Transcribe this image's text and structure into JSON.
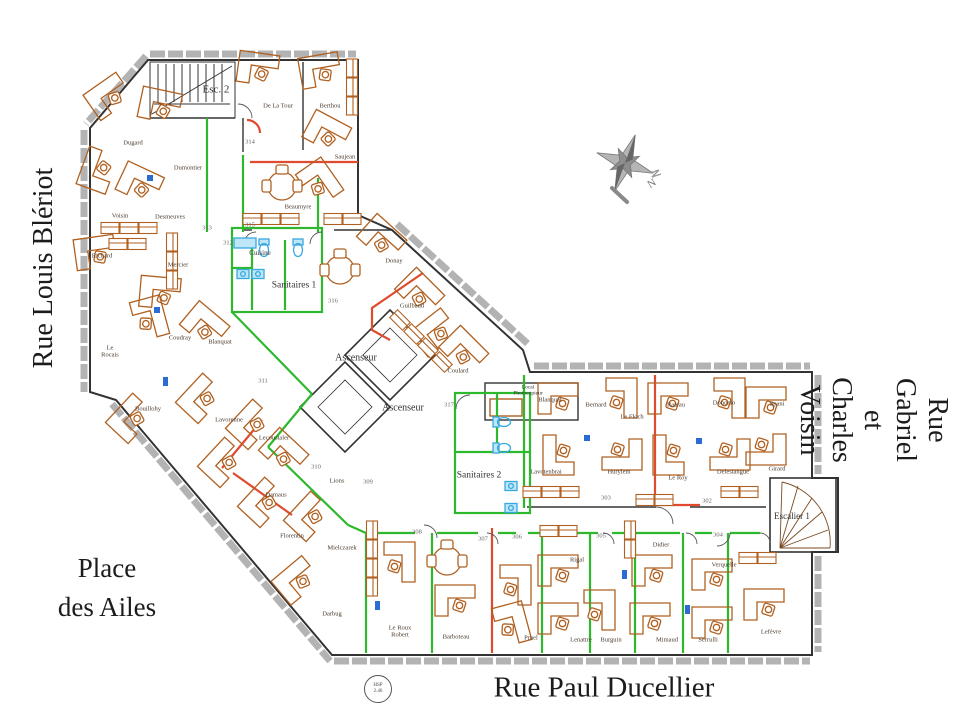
{
  "title": "Plan d'étage bureaux",
  "streets": {
    "left": "Rue Louis Blériot",
    "right": "Rue Gabriel et Charles Voisin",
    "bottom": "Rue Paul Ducellier",
    "place": "Place\ndes Ailes"
  },
  "compass": {
    "label": "N"
  },
  "stamp": {
    "top": "HSP",
    "bottom": "2.46"
  },
  "colors": {
    "desk_orange": "#b06020",
    "partition_green": "#2eb82e",
    "partition_red": "#e04a2f",
    "fixture_blue": "#36a9e0",
    "wall_dark": "#333333",
    "window_gray": "#9a9a9a"
  },
  "plan": {
    "room_labels": [
      {
        "t": "Esc. 2",
        "x": 216,
        "y": 90,
        "s": 11
      },
      {
        "t": "Cuisine",
        "x": 260,
        "y": 253,
        "s": 7
      },
      {
        "t": "Sanitaires 1",
        "x": 294,
        "y": 286,
        "s": 9.5
      },
      {
        "t": "Ascenseur",
        "x": 356,
        "y": 358,
        "s": 10
      },
      {
        "t": "Ascenseur",
        "x": 403,
        "y": 408,
        "s": 10
      },
      {
        "t": "Local\nPhotocopieur",
        "x": 528,
        "y": 391,
        "s": 5.5
      },
      {
        "t": "Sanitaires 2",
        "x": 479,
        "y": 476,
        "s": 9.5
      },
      {
        "t": "Escalier 1",
        "x": 792,
        "y": 516,
        "s": 9
      }
    ],
    "room_numbers": [
      {
        "t": "314",
        "x": 250,
        "y": 142
      },
      {
        "t": "313",
        "x": 207,
        "y": 228
      },
      {
        "t": "315",
        "x": 250,
        "y": 225
      },
      {
        "t": "312",
        "x": 228,
        "y": 243
      },
      {
        "t": "311",
        "x": 263,
        "y": 381
      },
      {
        "t": "310",
        "x": 316,
        "y": 467
      },
      {
        "t": "309",
        "x": 368,
        "y": 482
      },
      {
        "t": "308",
        "x": 417,
        "y": 532
      },
      {
        "t": "307",
        "x": 483,
        "y": 539
      },
      {
        "t": "306",
        "x": 517,
        "y": 537
      },
      {
        "t": "305",
        "x": 601,
        "y": 536
      },
      {
        "t": "304",
        "x": 718,
        "y": 535
      },
      {
        "t": "303",
        "x": 606,
        "y": 498
      },
      {
        "t": "302",
        "x": 707,
        "y": 501
      },
      {
        "t": "316",
        "x": 333,
        "y": 301
      },
      {
        "t": "317",
        "x": 449,
        "y": 405
      }
    ],
    "occupants": [
      {
        "t": "Dugard",
        "x": 133,
        "y": 143
      },
      {
        "t": "Dumontier",
        "x": 188,
        "y": 168
      },
      {
        "t": "Voisin",
        "x": 120,
        "y": 216
      },
      {
        "t": "Desmeuves",
        "x": 170,
        "y": 217
      },
      {
        "t": "Richard",
        "x": 102,
        "y": 256
      },
      {
        "t": "Mercier",
        "x": 178,
        "y": 265
      },
      {
        "t": "Coudray",
        "x": 180,
        "y": 338
      },
      {
        "t": "Blanquat",
        "x": 220,
        "y": 342
      },
      {
        "t": "Le\nRocais",
        "x": 110,
        "y": 352
      },
      {
        "t": "Bouillohy",
        "x": 148,
        "y": 409
      },
      {
        "t": "Lavorenne",
        "x": 229,
        "y": 420
      },
      {
        "t": "Lecoustaler",
        "x": 274,
        "y": 438
      },
      {
        "t": "Damaus",
        "x": 276,
        "y": 495
      },
      {
        "t": "Lions",
        "x": 337,
        "y": 481
      },
      {
        "t": "Florentin",
        "x": 292,
        "y": 536
      },
      {
        "t": "Mielczarek",
        "x": 342,
        "y": 548
      },
      {
        "t": "Darbug",
        "x": 332,
        "y": 614
      },
      {
        "t": "Le Roux\nRobert",
        "x": 400,
        "y": 632
      },
      {
        "t": "Barboteau",
        "x": 456,
        "y": 637
      },
      {
        "t": "Pruel",
        "x": 531,
        "y": 638
      },
      {
        "t": "Rigal",
        "x": 577,
        "y": 560
      },
      {
        "t": "Lenattre",
        "x": 581,
        "y": 640
      },
      {
        "t": "Burguin",
        "x": 611,
        "y": 640
      },
      {
        "t": "Didier",
        "x": 661,
        "y": 545
      },
      {
        "t": "Mimaud",
        "x": 667,
        "y": 640
      },
      {
        "t": "Verquelle",
        "x": 724,
        "y": 565
      },
      {
        "t": "Serrulli",
        "x": 708,
        "y": 640
      },
      {
        "t": "Lefèvre",
        "x": 771,
        "y": 632
      },
      {
        "t": "De La Tour",
        "x": 278,
        "y": 106
      },
      {
        "t": "Berthou",
        "x": 330,
        "y": 106
      },
      {
        "t": "Saujean",
        "x": 345,
        "y": 157
      },
      {
        "t": "Beaumyre",
        "x": 298,
        "y": 207
      },
      {
        "t": "Donay",
        "x": 394,
        "y": 261
      },
      {
        "t": "Guilbaud",
        "x": 412,
        "y": 306
      },
      {
        "t": "Coulard",
        "x": 458,
        "y": 371
      },
      {
        "t": "Blanquat",
        "x": 550,
        "y": 400
      },
      {
        "t": "Bernard",
        "x": 596,
        "y": 405
      },
      {
        "t": "Le Floch",
        "x": 632,
        "y": 417
      },
      {
        "t": "Lavotenbrai",
        "x": 546,
        "y": 472
      },
      {
        "t": "Hurylem",
        "x": 619,
        "y": 472
      },
      {
        "t": "Rateau",
        "x": 676,
        "y": 405
      },
      {
        "t": "Donorso",
        "x": 724,
        "y": 403
      },
      {
        "t": "Spani",
        "x": 777,
        "y": 404
      },
      {
        "t": "Le Roy",
        "x": 678,
        "y": 478
      },
      {
        "t": "Delestangue",
        "x": 733,
        "y": 472
      },
      {
        "t": "Girard",
        "x": 777,
        "y": 469
      }
    ]
  }
}
